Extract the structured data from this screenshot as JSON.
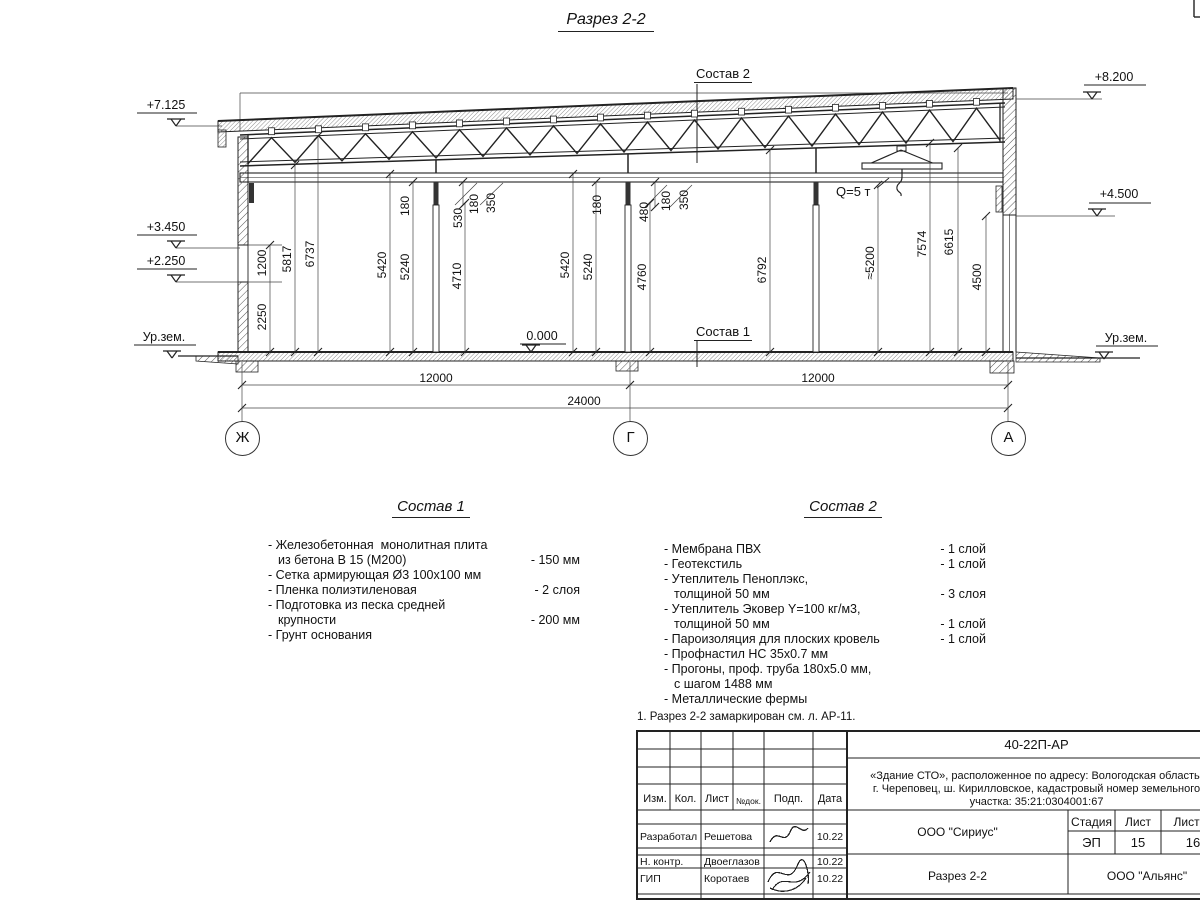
{
  "sheet": {
    "title": "Разрез 2-2"
  },
  "elevations": {
    "e7125": "+7.125",
    "e3450": "+3.450",
    "e2250": "+2.250",
    "ground_left": "Ур.зем.",
    "e8200": "+8.200",
    "e4500": "+4.500",
    "ground_right": "Ур.зем.",
    "zero": "0.000"
  },
  "refs": {
    "sostav2": "Состав 2",
    "sostav1": "Состав 1",
    "crane": "Q=5 т"
  },
  "axes": {
    "left": "Ж",
    "mid": "Г",
    "right": "А"
  },
  "dims": {
    "v": [
      "1200",
      "2250",
      "5817",
      "6737",
      "5420",
      "5240",
      "4710",
      "180",
      "530",
      "180",
      "350",
      "5420",
      "5240",
      "180",
      "4760",
      "480",
      "180",
      "350",
      "6792",
      "≈5200",
      "7574",
      "6615",
      "4500"
    ],
    "h": {
      "span_left": "12000",
      "span_right": "12000",
      "total": "24000"
    }
  },
  "sostav1": {
    "title": "Состав 1",
    "items": [
      {
        "name": "- Железобетонная  монолитная плита\nиз бетона В 15 (М200)",
        "value": "- 150 мм"
      },
      {
        "name": "- Сетка армирующая Ø3 100х100 мм",
        "value": ""
      },
      {
        "name": "- Пленка полиэтиленовая",
        "value": "-  2 слоя"
      },
      {
        "name": "- Подготовка из песка средней\nкрупности",
        "value": "- 200 мм"
      },
      {
        "name": "- Грунт основания",
        "value": ""
      }
    ]
  },
  "sostav2": {
    "title": "Состав 2",
    "items": [
      {
        "name": "- Мембрана ПВХ",
        "value": "- 1 слой"
      },
      {
        "name": "- Геотекстиль",
        "value": "- 1 слой"
      },
      {
        "name": "- Утеплитель Пеноплэкс,\nтолщиной 50 мм",
        "value": "- 3 слоя"
      },
      {
        "name": "- Утеплитель Эковер Y=100 кг/м3,\nтолщиной 50 мм",
        "value": "- 1 слой"
      },
      {
        "name": "- Пароизоляция для плоских кровель",
        "value": "- 1 слой"
      },
      {
        "name": "- Профнастил НС 35х0.7 мм",
        "value": ""
      },
      {
        "name": "- Прогоны, проф. труба 180х5.0 мм,\nс шагом 1488 мм",
        "value": ""
      },
      {
        "name": "- Металлические фермы",
        "value": ""
      }
    ]
  },
  "note": "1. Разрез 2-2 замаркирован см. л. АР-11.",
  "stamp": {
    "doc_number": "40-22П-АР",
    "project": "«Здание СТО», расположенное по адресу: Вологодская область,\nг. Череповец, ш. Кирилловское, кадастровый номер земельного\nучастка: 35:21:0304001:67",
    "cols": [
      "Изм.",
      "Кол.",
      "Лист",
      "№док.",
      "Подп.",
      "Дата"
    ],
    "rows": [
      {
        "role": "Разработал",
        "name": "Решетова",
        "date": "10.22"
      },
      {
        "role": "Н. контр.",
        "name": "Двоеглазов",
        "date": "10.22"
      },
      {
        "role": "ГИП",
        "name": "Коротаев",
        "date": "10.22"
      }
    ],
    "org1": "ООО \"Сириус\"",
    "stage_label": "Стадия",
    "sheet_label": "Лист",
    "sheets_label": "Листов",
    "stage": "ЭП",
    "sheet": "15",
    "sheets": "16",
    "sheet_title": "Разрез 2-2",
    "org2": "ООО \"Альянс\""
  }
}
